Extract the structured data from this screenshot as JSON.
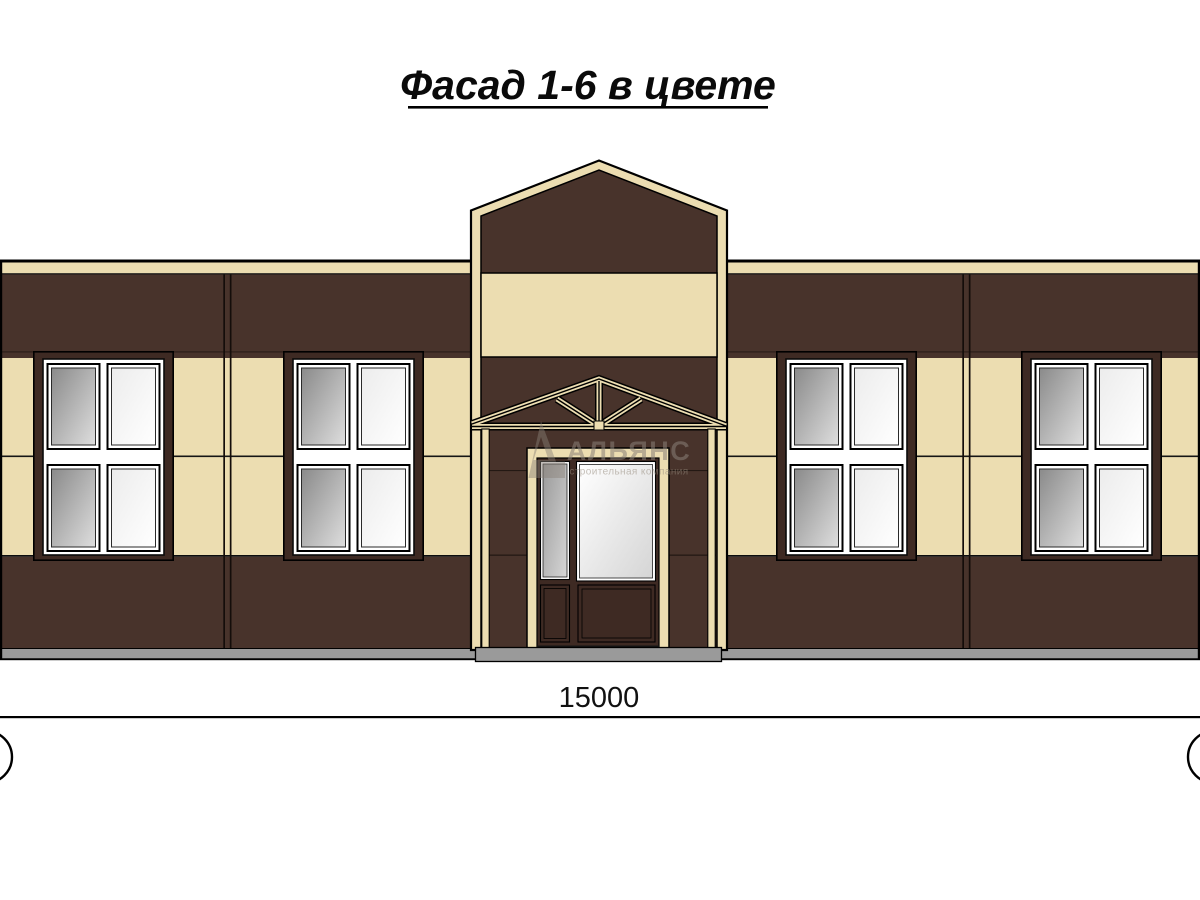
{
  "title": {
    "text": "Фасад 1-6 в цвете"
  },
  "dimension": {
    "value": "15000"
  },
  "watermark": {
    "brand": "АЛЬЯНС",
    "tagline": "строительная компания",
    "logo": "alliance-triangle-logo"
  },
  "palette": {
    "cream": "#ecddb1",
    "brown": "#48332b",
    "brown-dark": "#3e2a23",
    "plinth": "#9a9a9a",
    "watermark": "#8a8178",
    "glass-dark-a": "#8a8a8a",
    "glass-dark-b": "#dedede",
    "glass-light-a": "#ececec",
    "glass-light-b": "#ffffff",
    "side-glass-a": "#9a9a9a",
    "side-glass-b": "#d6d6d6",
    "door-glass-a": "#ffffff",
    "door-glass-b": "#d5d5d5"
  }
}
